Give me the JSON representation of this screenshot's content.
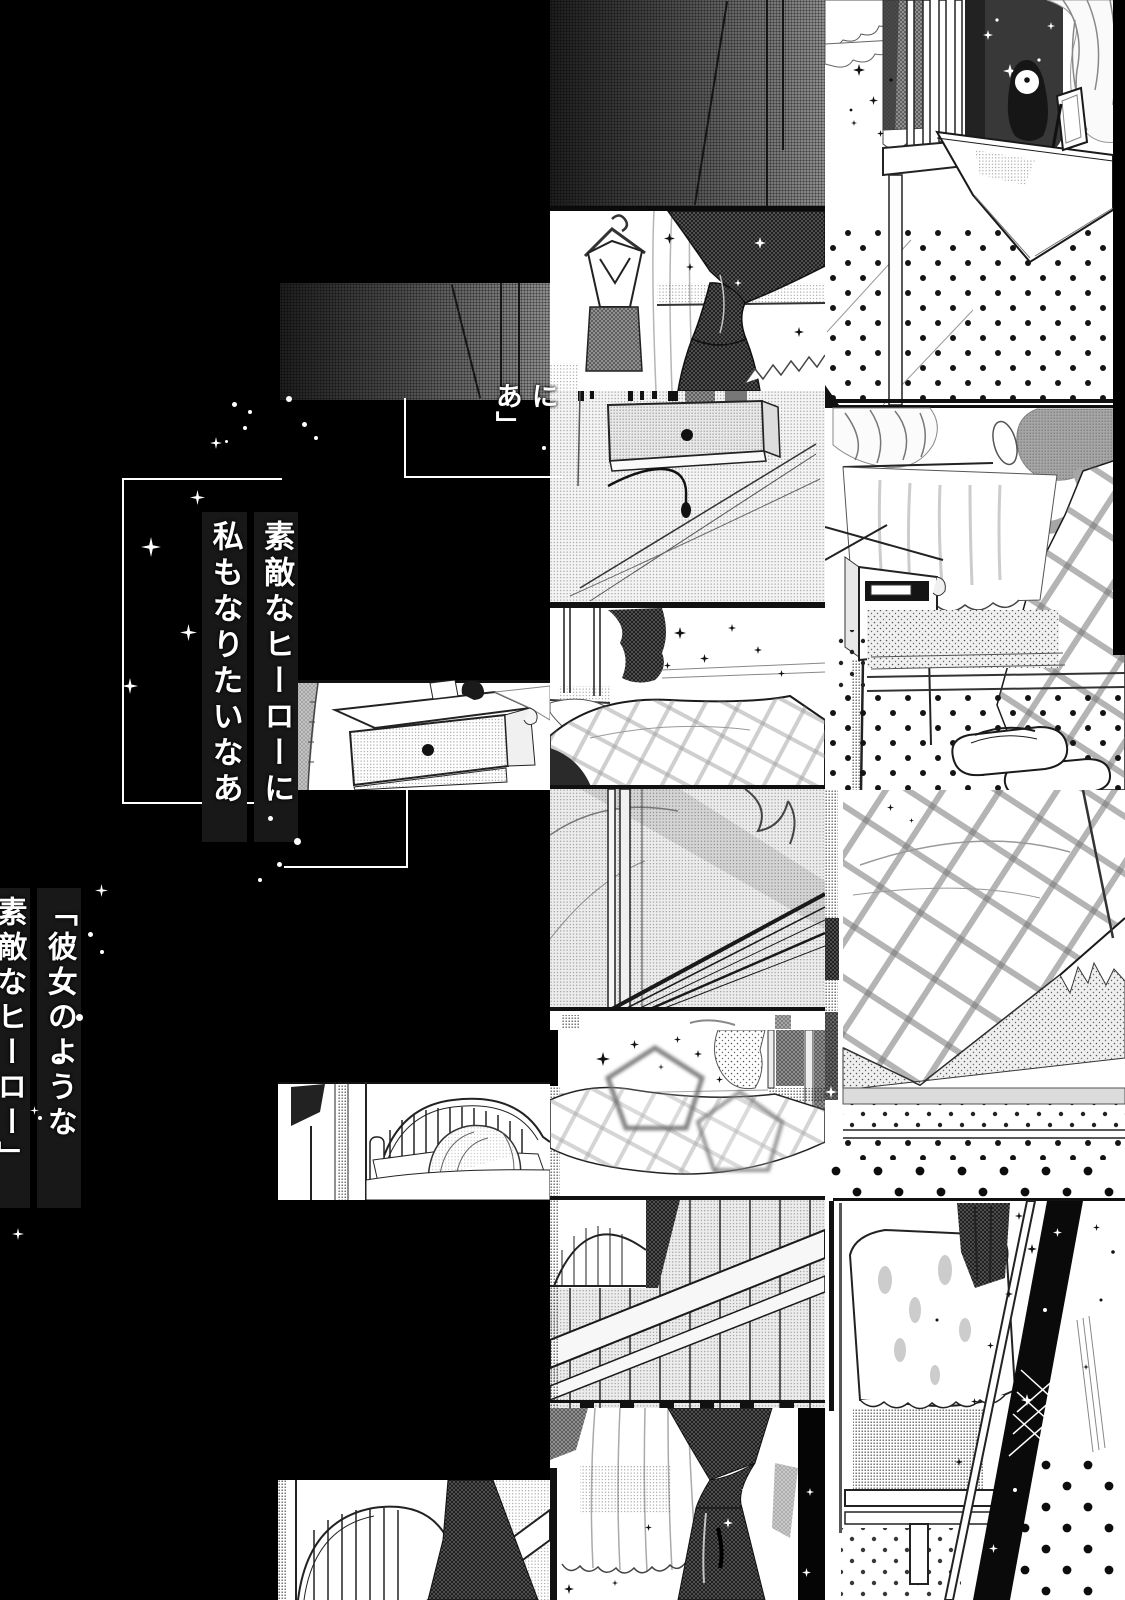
{
  "page": {
    "type": "manga-page",
    "background_color": "#000000",
    "ink_color": "#1a1a1a",
    "paper_color": "#ffffff",
    "tone_gray": "#8d8d8d"
  },
  "captions": {
    "monologue": {
      "line1": "素敵なヒーローに",
      "line2": "私もなりたいなあ"
    },
    "quote": {
      "line1": "「彼女のような",
      "line2": "素敵なヒーロー」"
    },
    "fragment": {
      "col1": "に",
      "col2": "あ」"
    }
  }
}
